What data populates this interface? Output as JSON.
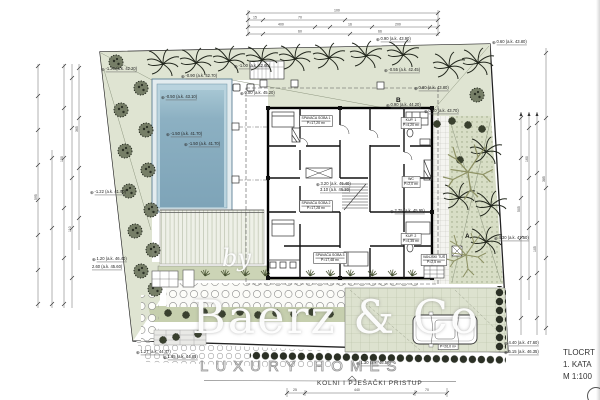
{
  "title_block": {
    "title": "TLOCRT",
    "floor": "1. KATA",
    "scale": "M 1:100"
  },
  "street_label": "KOLNI I PJEŠAČKI PRISTUP",
  "watermark": {
    "by": "by",
    "name": "Baerz & Co",
    "tagline": "LUXURY HOMES"
  },
  "section_markers": {
    "a": "A",
    "b": "B"
  },
  "annotations": [
    {
      "text": "-1.20 (a.k. 42.20)"
    },
    {
      "text": "-0.90 (a.k. 42.70)"
    },
    {
      "text": "-1.00 (a.k. 42.60)"
    },
    {
      "text": "0.90 (a.k. 43.90)"
    },
    {
      "text": "0.60 (a.k. 43.80)"
    },
    {
      "text": "-0.55 (a.k. 42.45)"
    },
    {
      "text": "-0.50 (a.k. 43.10)"
    },
    {
      "text": "0.00 (a.k. 45.20)"
    },
    {
      "text": "-1.50 (a.k. 41.70)"
    },
    {
      "text": "-1.50 (a.k. 41.70)"
    },
    {
      "text": "0.80 (a.k. 43.80)"
    },
    {
      "text": "0.90 (a.k. 44.20)"
    },
    {
      "text": "0.50 (a.k. 43.70)"
    },
    {
      "text": "3.20 (a.k. 46.40)"
    },
    {
      "text": "3.10 (a.k. 46.30)"
    },
    {
      "text": "-1.22 (a.k. 41.90)"
    },
    {
      "text": "1.20 (a.k. 46.40)"
    },
    {
      "text": "2.60 (a.k. 45.60)"
    },
    {
      "text": "1.27 (a.k. 44.47)"
    },
    {
      "text": "1.65 (a.k. 44.85)"
    },
    {
      "text": "4.30 (a.k. 47.50)"
    },
    {
      "text": "4.40 (a.k. 47.60)"
    },
    {
      "text": "5.15 (a.k. 46.35)"
    },
    {
      "text": "2.75 (a.k. 45.95)"
    },
    {
      "text": "1.30 (a.k. 46.50)"
    }
  ],
  "rooms": [
    {
      "name": "SPAVAĆA SOBA 1",
      "area": "P=17,20 m²"
    },
    {
      "name": "SPAVAĆA SOBA 2",
      "area": "P=17,28 m²"
    },
    {
      "name": "SPAVAĆA SOBA 3",
      "area": "P=17,48 m²"
    },
    {
      "name": "KUP. 1",
      "area": "P=4,20 m²"
    },
    {
      "name": "WC",
      "area": "P=2,0 m²"
    },
    {
      "name": "KUP. 2",
      "area": "P=4,35 m²"
    },
    {
      "name": "VANJSKI TUŠ",
      "area": "P=2,5 m²"
    },
    {
      "name": "P=26,0 m²",
      "area": ""
    }
  ],
  "dims": {
    "top": [
      "100",
      "15",
      "70",
      "400",
      "16",
      "200",
      "60",
      "66"
    ],
    "bottom": [
      "25",
      "440",
      "70"
    ],
    "left": [
      "595",
      "150",
      "110",
      "365"
    ],
    "right": [
      "505",
      "160",
      "105",
      "385"
    ]
  },
  "colors": {
    "green_light": "#dfe4d2",
    "green_garden": "#d8dec6",
    "pool_water": "#7ea4b8",
    "pool_ledge": "#b9d3de",
    "hedge": "#2b3025",
    "branch": "#8e9265"
  }
}
